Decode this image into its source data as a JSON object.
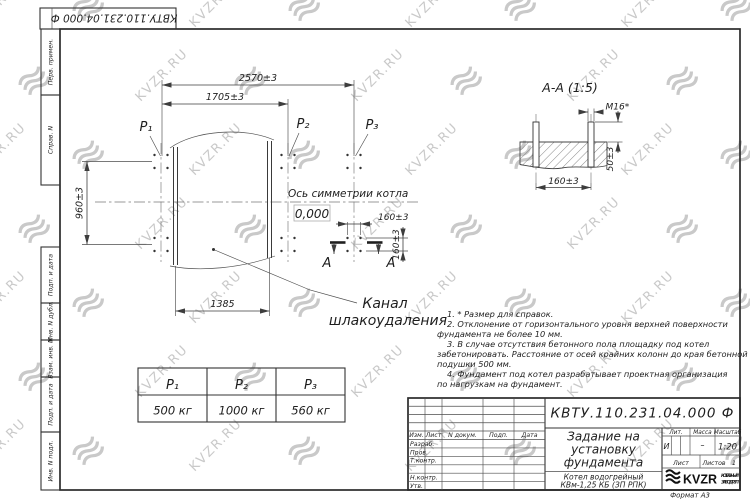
{
  "watermark": {
    "text": "KVZR.RU",
    "color": "#c9c9c9"
  },
  "frame": {
    "corner_stamp": "КВТУ.110.231.04.000 Ф",
    "side_labels": [
      "Перв. примен.",
      "Справ. N",
      "Подп. и дата",
      "Инв. N дубл.",
      "Взам. инв. N",
      "Подп. и дата",
      "Инв. N подл."
    ]
  },
  "plan": {
    "dim_2570": "2570±3",
    "dim_1705": "1705±3",
    "dim_960": "960±3",
    "dim_1385": "1385",
    "dim_160_h": "160±3",
    "dim_160_v": "160±3",
    "load_p1": "P₁",
    "load_p2": "P₂",
    "load_p3": "P₃",
    "axis_label": "Ось симметрии котла",
    "level_mark": "0,000",
    "section_letter_left": "А",
    "section_letter_right": "А",
    "channel_label_1": "Канал",
    "channel_label_2": "шлакоудаления"
  },
  "section": {
    "title": "А-А (1:5)",
    "thread_label": "М16*",
    "dim_50": "50±3",
    "dim_160": "160±3"
  },
  "notes": {
    "lines": [
      "1. * Размер для справок.",
      "2. Отклонение от горизонтального уровня верхней поверхности",
      "фундамента не более 10 мм.",
      "3. В случае отсутствия бетонного пола площадку под котел",
      "забетонировать. Расстояние от осей крайних колонн до края бетонной",
      "подушки 500 мм.",
      "4. Фундамент под котел разрабатывает проектная организация",
      "по нагрузкам на фундамент."
    ]
  },
  "load_table": {
    "headers": [
      "P₁",
      "P₂",
      "P₃"
    ],
    "values": [
      "500 кг",
      "1000 кг",
      "560 кг"
    ]
  },
  "title_block": {
    "doc_number": "КВТУ.110.231.04.000 Ф",
    "title_line1": "Задание на",
    "title_line2": "установку",
    "title_line3": "фундамента",
    "subtitle_line1": "Котел водогрейный",
    "subtitle_line2": "КВм-1,25 КБ  (ЗП РПК)",
    "col_izm": "Изм.",
    "col_list": "Лист",
    "col_doc": "N докум.",
    "col_podp": "Подп.",
    "col_data": "Дата",
    "row_razrab": "Разраб.",
    "row_prov": "Пров.",
    "row_tkontr": "Т.контр.",
    "row_nkontr": "Н.контр.",
    "row_utv": "Утв.",
    "lit_header": "Лит.",
    "mass_header": "Масса",
    "scale_header": "Масштаб",
    "lit_value": "И",
    "mass_value": "–",
    "scale_value": "1:20",
    "sheet_label": "Лист",
    "sheets_label": "Листов",
    "sheets_value": "1",
    "logo_text": "KVZR",
    "company_line1": "КОТЕЛЬНЫЙ",
    "company_line2": "ЗАВОД РЭП",
    "format_label": "Формат А3"
  }
}
